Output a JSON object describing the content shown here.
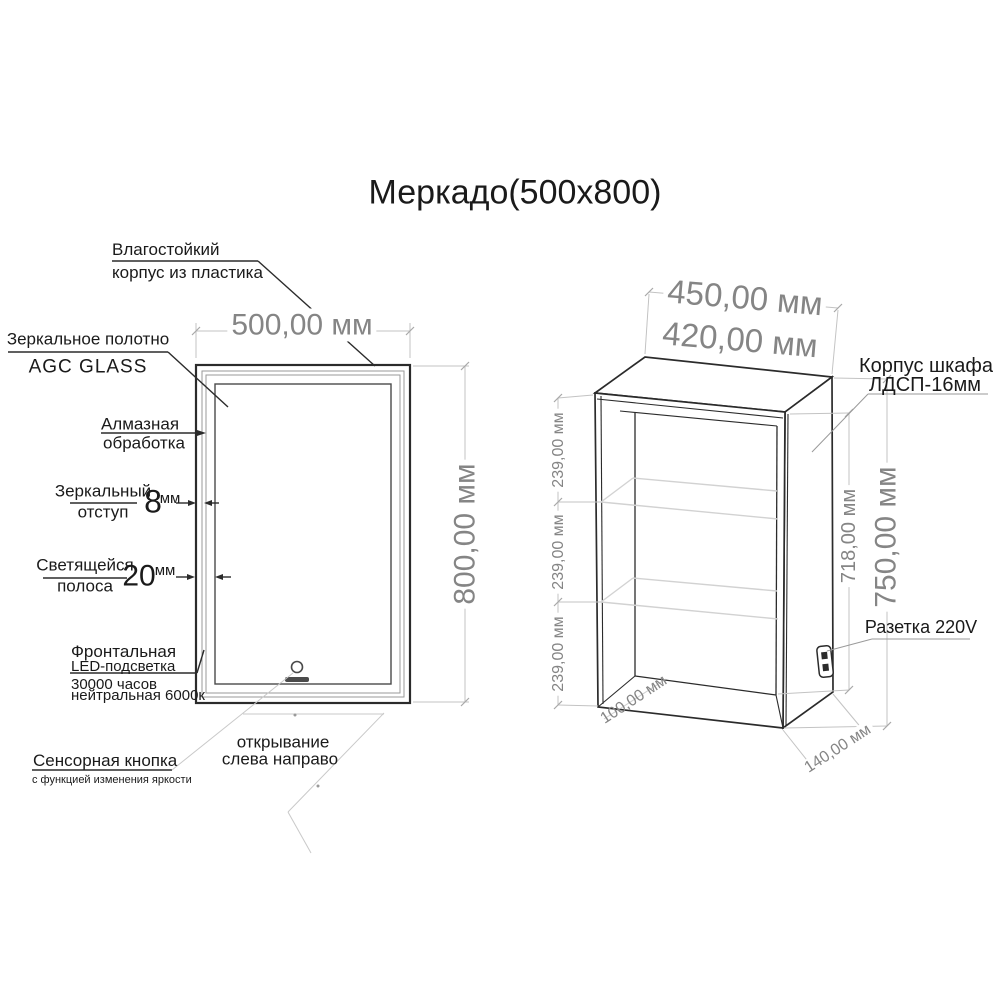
{
  "title": "Меркадо(500x800)",
  "colors": {
    "drawing_line": "#2b2b2b",
    "dim_line": "#c3c3c3",
    "dim_text": "#858585",
    "label_text": "#1a1a1a",
    "shelf_line": "#d2d2d2"
  },
  "mirror_view": {
    "dim_width": "500,00 мм",
    "dim_height": "800,00 мм",
    "case_label": {
      "line1": "Влагостойкий",
      "line2": "корпус из пластика"
    },
    "glass_label": {
      "line1": "Зеркальное полотно",
      "line2": "AGC GLASS"
    },
    "edge_label": {
      "line1": "Алмазная",
      "line2": "обработка"
    },
    "offset_label": {
      "line1": "Зеркальный",
      "line2": "отступ",
      "value": "8",
      "unit": "мм"
    },
    "strip_label": {
      "line1": "Светящейся",
      "line2": "полоса",
      "value": "20",
      "unit": "мм"
    },
    "led_label": {
      "line1": "Фронтальная",
      "line2": "LED-подсветка",
      "line3": "30000 часов",
      "line4": "нейтральная 6000к"
    },
    "sensor_label": {
      "line1": "Сенсорная кнопка",
      "line2": "с функцией изменения яркости"
    },
    "opening_label": {
      "line1": "открывание",
      "line2": "слева направо"
    }
  },
  "cabinet_view": {
    "dim_outer_width": "450,00 мм",
    "dim_inner_width": "420,00 мм",
    "shelf_dims": [
      "239,00 мм",
      "239,00 мм",
      "239,00 мм"
    ],
    "dim_inner_height": "718,00 мм",
    "dim_height": "750,00 мм",
    "dim_bottom_depth": "100,00 мм",
    "dim_side_depth": "140,00 мм",
    "body_label": {
      "line1": "Корпус шкафа",
      "line2": "ЛДСП-16мм"
    },
    "socket_label": "Разетка 220V"
  }
}
